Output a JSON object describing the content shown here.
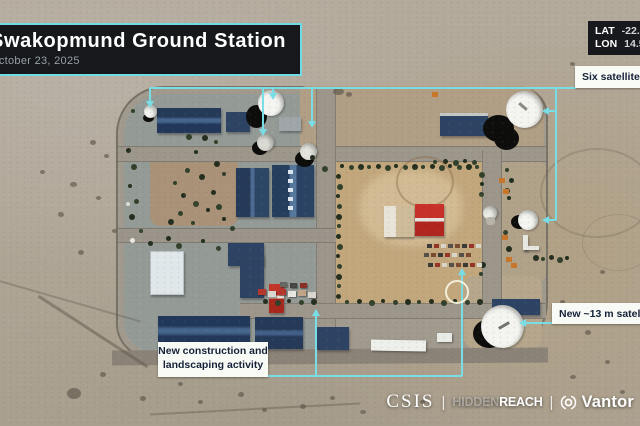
{
  "banner": {
    "title": "Swakopmund Ground Station",
    "date": "October 23, 2025"
  },
  "coords": {
    "lat_label": "LAT",
    "lat_value": "-22.57",
    "lon_label": "LON",
    "lon_value": "14.54"
  },
  "annotations": {
    "six_dishes_label": "Six satellite dishes",
    "new_dish_label": "New ~13 m satellite dish",
    "construction_line1": "New construction and",
    "construction_line2": "landscaping activity"
  },
  "footer": {
    "csis": "CSIS",
    "separator": "|",
    "hidden": "HIDDEN",
    "reach": "REACH",
    "vantor": "Vantor",
    "vantor_icon": "vantor-aperture-icon"
  },
  "colors": {
    "annotation_cyan": "#79dde6",
    "label_bg": "#f8faf6",
    "label_text": "#152238",
    "banner_bg": "#16181c",
    "banner_border": "#6fdbe5"
  }
}
